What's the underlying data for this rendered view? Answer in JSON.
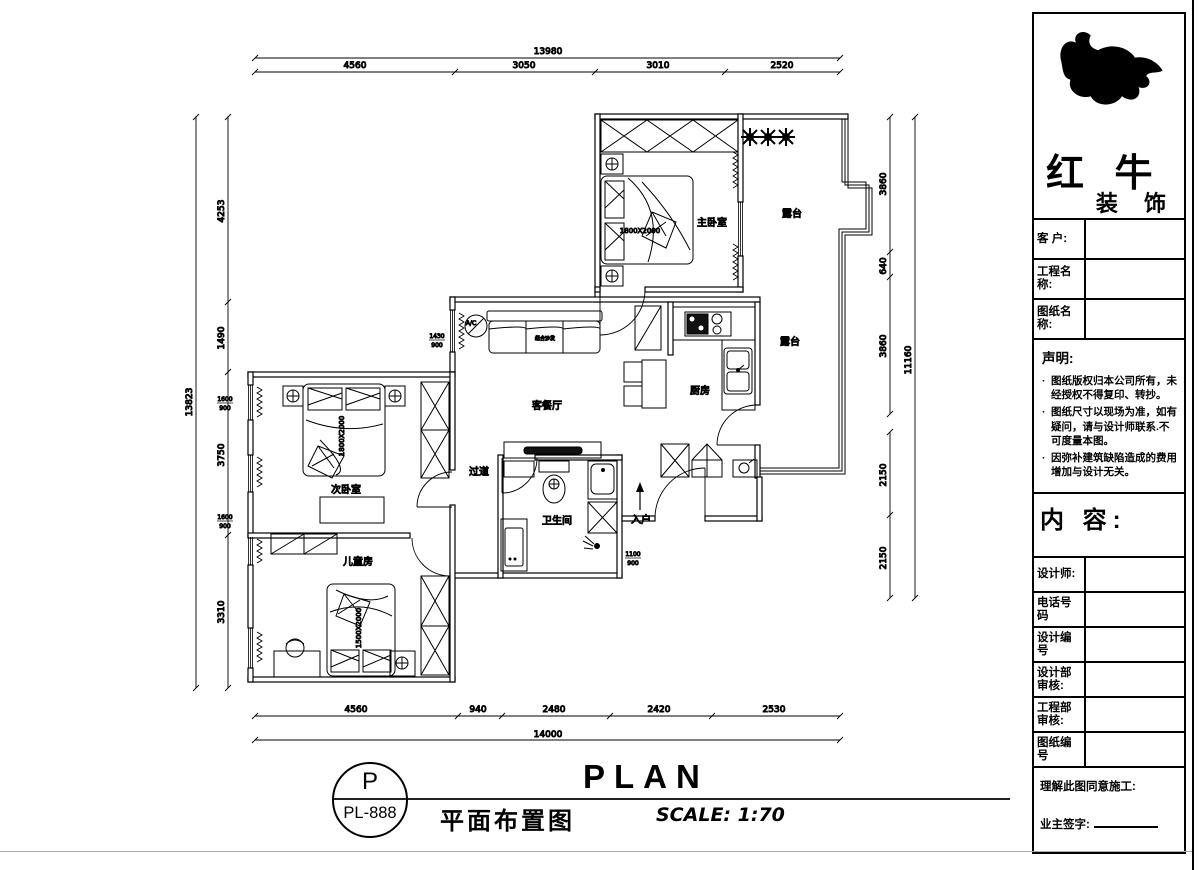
{
  "title_block": {
    "brand": {
      "line1": "红 牛",
      "line2": "装 饰"
    },
    "fields": [
      {
        "label": "客  户:"
      },
      {
        "label": "工程名称:"
      },
      {
        "label": "图纸名称:"
      }
    ],
    "statement": {
      "title": "声明:",
      "items": [
        "图纸版权归本公司所有，未经授权不得复印、转抄。",
        "图纸尺寸以现场为准，如有疑问，请与设计师联系.不可度量本图。",
        "因弥补建筑缺陷造成的费用增加与设计无关。"
      ]
    },
    "content_label": "内 容:",
    "fields2": [
      {
        "label": "设计师:"
      },
      {
        "label": "电话号码"
      },
      {
        "label": "设计编号"
      },
      {
        "label": "设计部审核:"
      },
      {
        "label": "工程部审核:"
      },
      {
        "label": "图纸编号"
      }
    ],
    "signature": {
      "line1": "理解此图同意施工:",
      "line2": "业主签字:"
    }
  },
  "title_bar": {
    "code_top": "P",
    "code_bottom": "PL-888",
    "drawing_name": "平面布置图",
    "plan_en": "PLAN",
    "scale": "SCALE: 1:70"
  },
  "rooms": {
    "master": "主卧室",
    "terrace1": "露台",
    "terrace2": "露台",
    "kitchen": "厨房",
    "living": "客餐厅",
    "corridor": "过道",
    "bath": "卫生间",
    "second": "次卧室",
    "kids": "儿童房",
    "entry": "入户"
  },
  "furniture": {
    "master_bed": "1800X2000",
    "second_bed": "1800X2000",
    "kids_bed": "1500X2000",
    "sofa": "组合沙发"
  },
  "marks": {
    "ac": "A/C",
    "win": [
      {
        "w": "1600",
        "h": "900"
      },
      {
        "w": "1600",
        "h": "900"
      },
      {
        "w": "1430",
        "h": "900"
      },
      {
        "w": "1100",
        "h": "900"
      }
    ]
  },
  "dims": {
    "top": {
      "overall": "13980",
      "segments": [
        "4560",
        "3050",
        "3010",
        "2520"
      ]
    },
    "bottom": {
      "overall": "14000",
      "segments": [
        "4560",
        "940",
        "2480",
        "2420",
        "2530"
      ]
    },
    "left": {
      "overall": "13823",
      "segments": [
        "4253",
        "1490",
        "3750",
        "3310"
      ]
    },
    "right": {
      "overall": "11160",
      "segments": [
        "3860",
        "640",
        "3860",
        "2150",
        "2150"
      ]
    }
  }
}
